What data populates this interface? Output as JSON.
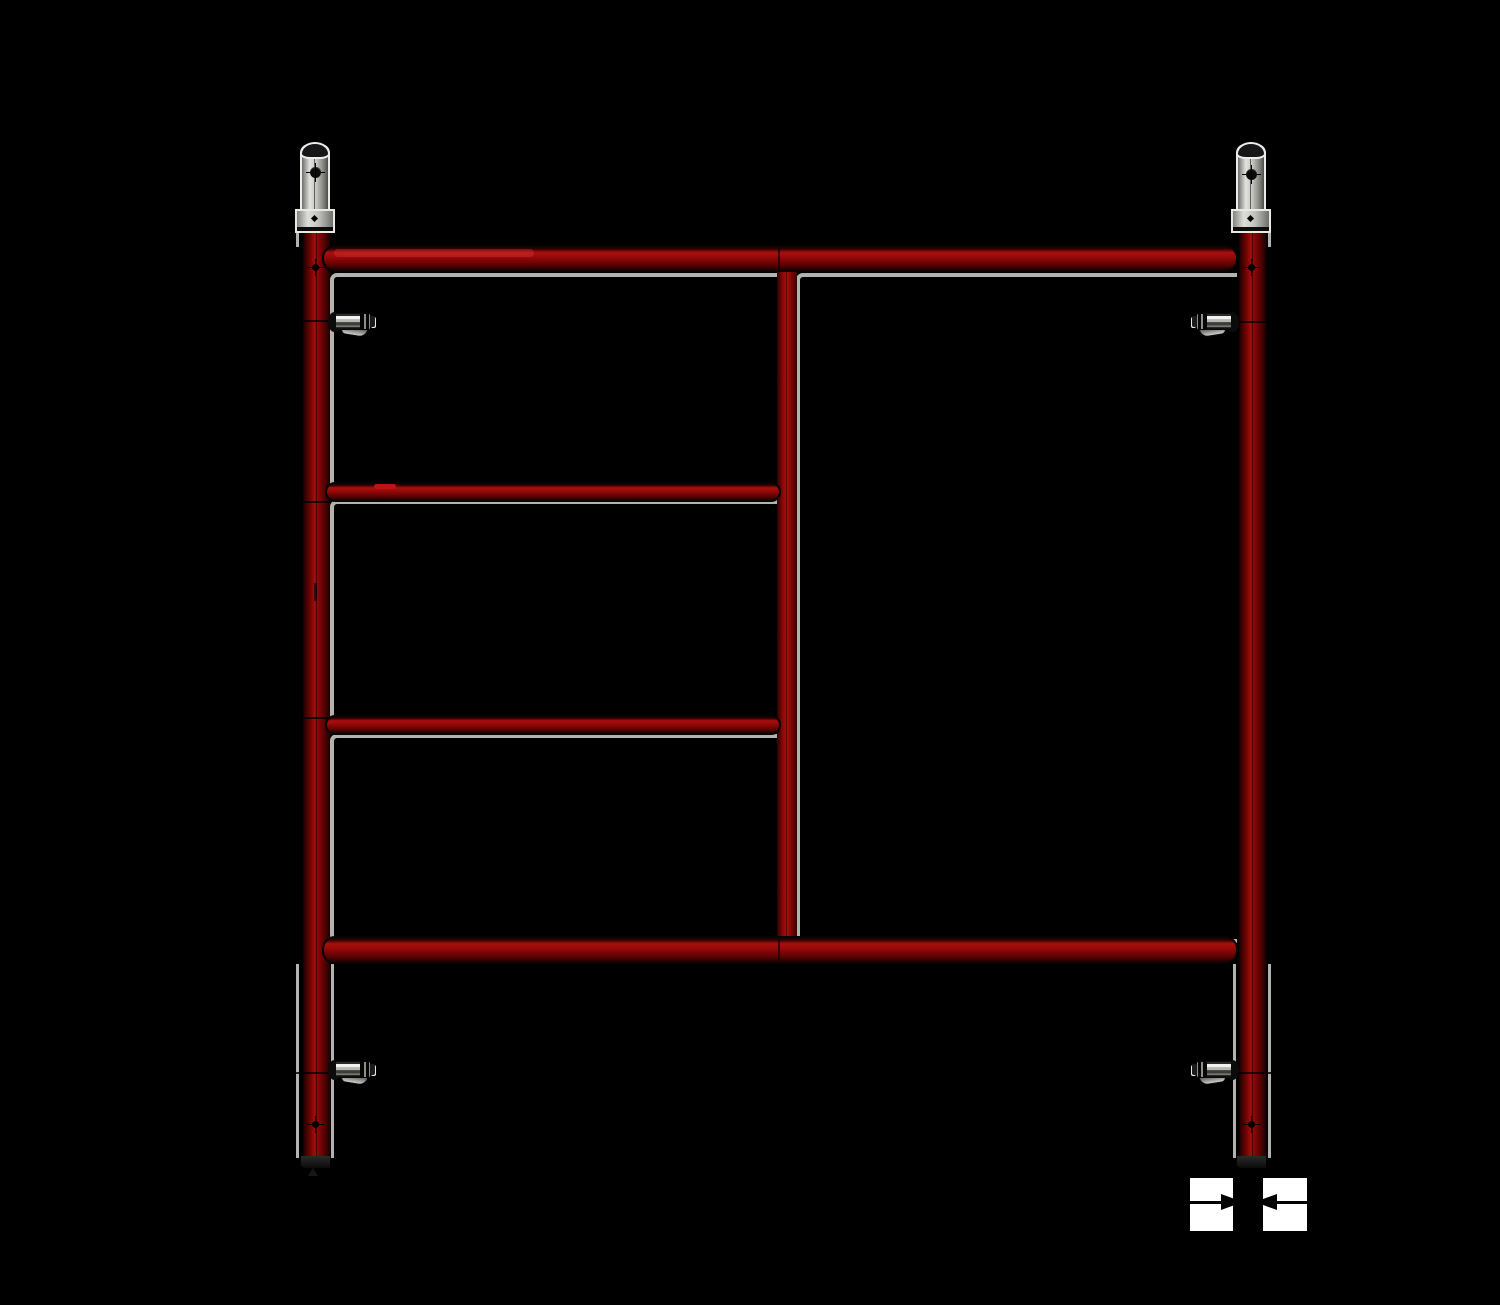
{
  "scene": {
    "type": "cad-render",
    "subject": "scaffold-ladder-end-frame"
  },
  "colors": {
    "bg": "#000000",
    "edge": "#b2b2ae",
    "steel-bright": "#e9e9e6",
    "steel-mid": "#c9c9c5",
    "steel-dark": "#6e6e6a",
    "red-bright": "#a80f0f",
    "red-mid": "#8e0707",
    "red-dark": "#3a0101",
    "outline": "#000000",
    "white": "#ffffff"
  },
  "components": {
    "posts": [
      "left-post",
      "center-post",
      "right-post"
    ],
    "horizontals": [
      "top-ledger-bar",
      "upper-rung",
      "lower-rung",
      "bottom-ledger-bar"
    ],
    "pins": [
      "coupling-pin-left",
      "coupling-pin-right"
    ],
    "locks": [
      "spring-lock-top-left",
      "spring-lock-top-right",
      "spring-lock-bottom-left",
      "spring-lock-bottom-right"
    ]
  },
  "annotation": {
    "left_arrow_icon": "arrow-right-icon",
    "right_arrow_icon": "arrow-left-icon",
    "meaning": "width-dimension-callout"
  }
}
